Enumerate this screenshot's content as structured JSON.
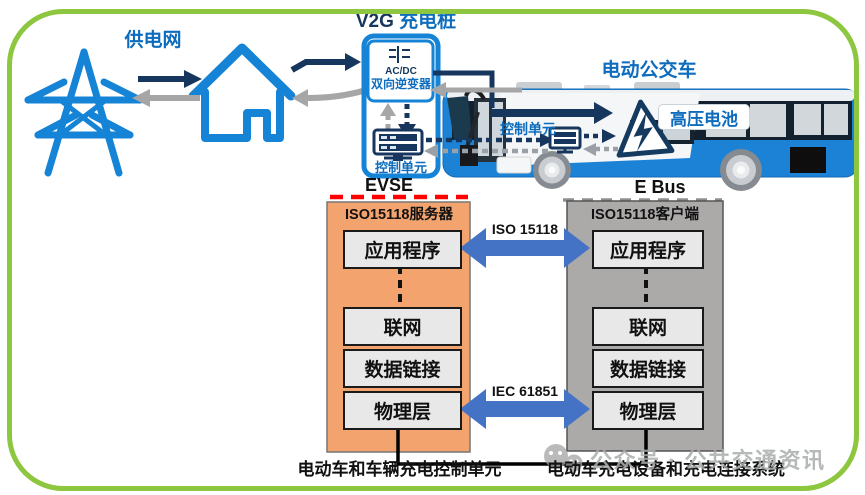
{
  "scene": {
    "top": {
      "grid_label": "供电网",
      "charger_title_en": "V2G",
      "charger_title_cn": "充电桩",
      "acdc_line1": "AC/DC",
      "acdc_line2": "双向逆变器",
      "charger_control_label": "控制单元",
      "bus_title": "电动公交车",
      "bus_control_label": "控制单元",
      "battery_label": "高压电池",
      "evse_label": "EVSE",
      "ebus_label": "E Bus"
    },
    "stacks": {
      "left": {
        "title": "ISO15118服务器",
        "layers": [
          "应用程序",
          "联网",
          "数据链接",
          "物理层"
        ]
      },
      "right": {
        "title": "ISO15118客户端",
        "layers": [
          "应用程序",
          "联网",
          "数据链接",
          "物理层"
        ]
      }
    },
    "protocols": {
      "app_layer": "ISO 15118",
      "phys_layer": "IEC 61851"
    },
    "footers": {
      "left": "电动车和车辆充电控制单元",
      "right": "电动车充电设备和充电连接系统"
    },
    "watermark": "公众号 · 公共交通资讯",
    "colors": {
      "frame_green": "#8DC63F",
      "icon_blue": "#1583d6",
      "label_blue": "#0d6cbd",
      "navy": "#17365d",
      "arrow_gray": "#a6a6a6",
      "big_arrow_blue": "#4472C4",
      "server_panel_orange": "#F2A36E",
      "client_panel_gray": "#ACA9A9",
      "evse_dash_red": "#FF0000",
      "bus_blue": "#1b82d6"
    }
  }
}
